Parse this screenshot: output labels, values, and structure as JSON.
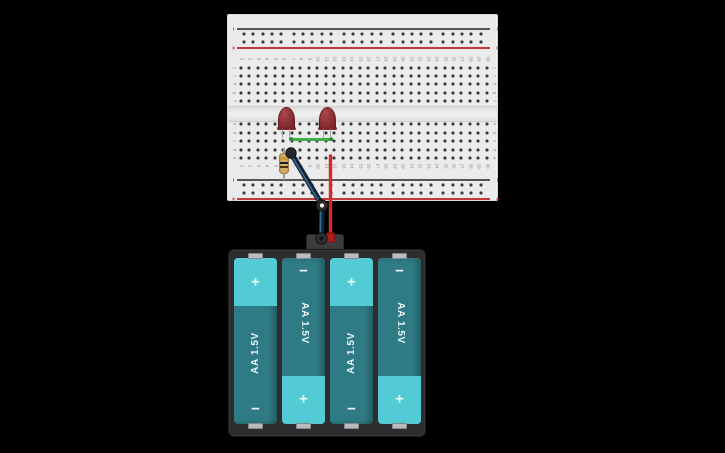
{
  "scene": {
    "background": "#000000"
  },
  "breadboard": {
    "rail_labels": {
      "minus": "−",
      "plus": "+"
    },
    "column_numbers": [
      "1",
      "2",
      "3",
      "4",
      "5",
      "6",
      "7",
      "8",
      "9",
      "10",
      "11",
      "12",
      "13",
      "14",
      "15",
      "16",
      "17",
      "18",
      "19",
      "20",
      "21",
      "22",
      "23",
      "24",
      "25",
      "26",
      "27",
      "28",
      "29",
      "30"
    ],
    "row_labels_top": [
      "j",
      "i",
      "h",
      "g",
      "f"
    ],
    "row_labels_bottom": [
      "e",
      "d",
      "c",
      "b",
      "a"
    ],
    "colors": {
      "body": "#ebebeb",
      "hole": "#3a3a3a",
      "red_line": "#c0393b",
      "dark_line": "#565656",
      "label_gray": "#8c8c8c",
      "plus_red": "#c0393b",
      "minus_gray": "#565656"
    }
  },
  "components": {
    "led_left": {
      "type": "red-led",
      "body_color_hi": "#a8474c",
      "body_color": "#8e3036",
      "body_color_lo": "#702027",
      "base_color": "#7c262b"
    },
    "led_right": {
      "type": "red-led",
      "body_color_hi": "#a8474c",
      "body_color": "#8e3036",
      "body_color_lo": "#702027",
      "base_color": "#7c262b"
    },
    "wire_green": {
      "color": "#3cae4a",
      "cap_color": "#27913a"
    },
    "wire_black": {
      "color": "#10222f",
      "highlight": "#3a6f9e",
      "node_fill": "#26282b",
      "bend_inner": "#f2f2f2",
      "terminal_inner": "#121517"
    },
    "wire_red": {
      "color": "#d22b2b",
      "connector_color": "#ad1d1d",
      "connector_edge": "#7d1313"
    },
    "resistor": {
      "body_color": "#d9b06c",
      "band_colors": [
        "#c79b3b",
        "#1e1e1e",
        "#4f2d12"
      ]
    }
  },
  "battery_pack": {
    "case_color": "#2d2d30",
    "cell_dark": "#2f7b85",
    "cell_light": "#52cbd4",
    "batteries": [
      {
        "label": "AA 1.5V",
        "orientation": "up",
        "top_sign": "+",
        "bottom_sign": "−"
      },
      {
        "label": "AA 1.5V",
        "orientation": "down",
        "top_sign": "−",
        "bottom_sign": "+"
      },
      {
        "label": "AA 1.5V",
        "orientation": "up",
        "top_sign": "+",
        "bottom_sign": "−"
      },
      {
        "label": "AA 1.5V",
        "orientation": "down",
        "top_sign": "−",
        "bottom_sign": "+"
      }
    ]
  }
}
